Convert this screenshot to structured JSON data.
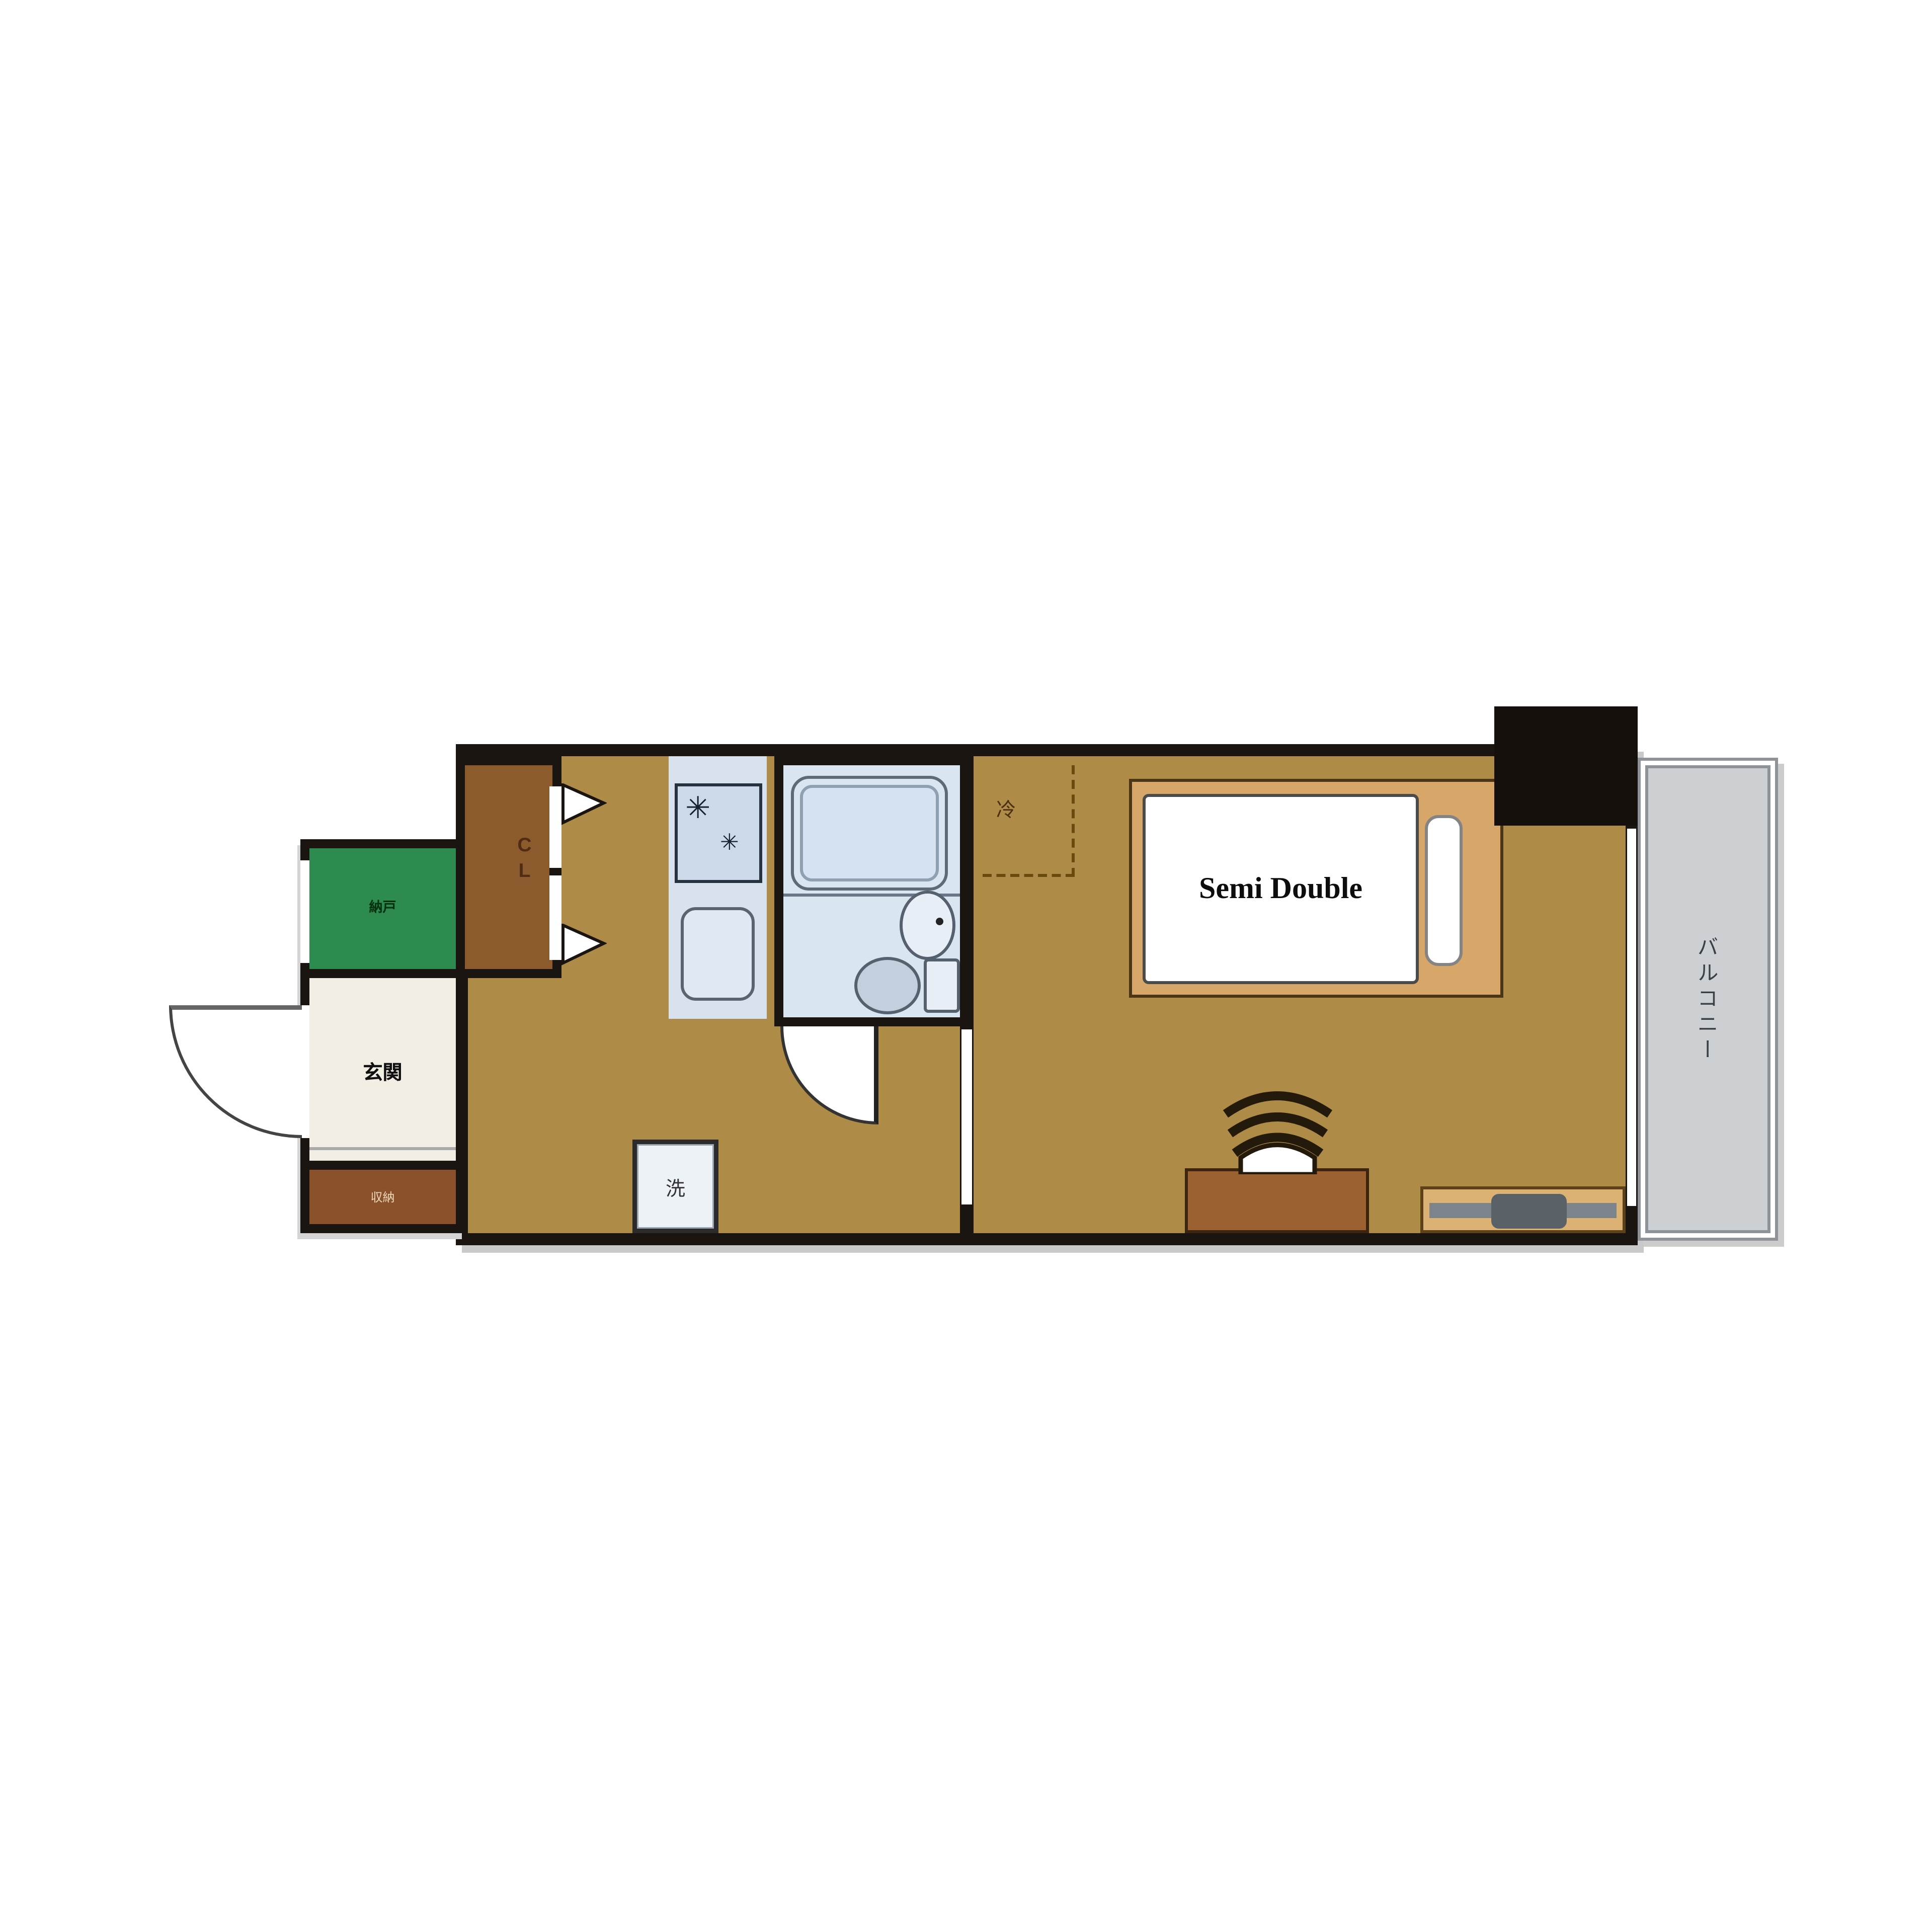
{
  "floorplan": {
    "rooms": {
      "green_storage": {
        "label": "納戸"
      },
      "genkan": {
        "label": "玄関"
      },
      "entrance_storage": {
        "label": "収納"
      },
      "closet": {
        "label": "CL"
      },
      "balcony": {
        "label": "バルコニー"
      }
    },
    "furniture": {
      "bed": {
        "label": "Semi Double"
      },
      "washer": {
        "label": "洗"
      },
      "refrigerator": {
        "label": "冷"
      }
    },
    "icons": {
      "burner_icon": "✳"
    },
    "colors": {
      "wall": "#1b1511",
      "floor": "#ae8b46",
      "green_room": "#2e8b50",
      "genkan_floor": "#f2eee3",
      "closet_brown": "#8b5b2e",
      "entrance_storage_brown": "#8a512b",
      "bathroom_blue": "#d9e5f1",
      "kitchen_fixture_blue": "#ccd9e9",
      "balcony_gray": "#cdd0d3",
      "bed_frame_tan": "#d6a768",
      "desk_brown": "#9c6130",
      "tv_board_tan": "#dbb273",
      "pillar_black": "#16100c"
    }
  }
}
